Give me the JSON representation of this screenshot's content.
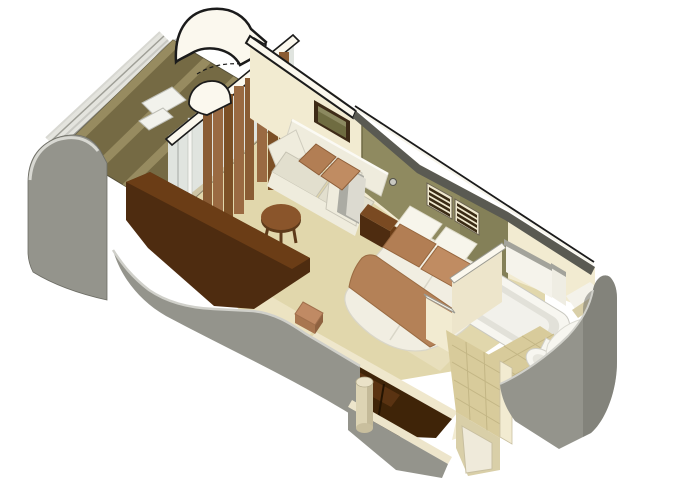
{
  "scene": {
    "title": "Stateroom 3D cutaway floor plan",
    "view": "isometric cutaway from above",
    "rooms": [
      {
        "name": "balcony",
        "items": [
          "teak-deck",
          "deck-lounger",
          "railing"
        ]
      },
      {
        "name": "living-area",
        "items": [
          "sofa",
          "accent-pillows",
          "coffee-table",
          "framed-picture",
          "curtains",
          "sliding-glass-door",
          "vanity-desk",
          "stool"
        ]
      },
      {
        "name": "sleeping-area",
        "items": [
          "double-bed",
          "white-pillows",
          "accent-pillows",
          "bed-runner",
          "nightstand",
          "headboard-wall",
          "air-vents",
          "reading-light-knob"
        ]
      },
      {
        "name": "bathroom",
        "items": [
          "bathtub",
          "toilet",
          "vanity-sink",
          "tiled-floor"
        ]
      },
      {
        "name": "entry",
        "items": [
          "wardrobe-closet",
          "column",
          "tiled-corridor",
          "cabin-door"
        ]
      }
    ]
  },
  "colors": {
    "outline": "#1b1b1b",
    "wallCream": "#F2EBD1",
    "wallBand": "#FBF8EE",
    "bandDark": "#5A5A52",
    "partition": "#EDE5CB",
    "carpet": "#E1D7AC",
    "carpetLight": "#EDE5C6",
    "threshold": "#CFC6A6",
    "grayWall": "#94948C",
    "grayWallDark": "#75756D",
    "grayWallLight": "#D0D0CA",
    "plankDark": "#756A44",
    "plankLight": "#978B60",
    "railBand": "#E4E4DE",
    "glass": "#E0E4DF",
    "mullion": "#F6F6F2",
    "curtainA": "#9A6A42",
    "curtainB": "#7C5026",
    "curtainC": "#8A5C34",
    "sofaBody": "#EFECDD",
    "sofaCushion": "#E2DFCE",
    "sofaArmGray": "#ABABA3",
    "pillowBrown": "#B27E54",
    "pillowBrownLight": "#C08C62",
    "frame": "#3E2B17",
    "art": "#6F6C41",
    "tableWood": "#8A552B",
    "tableWoodDark": "#5E3A1A",
    "olive": "#8F8A60",
    "oliveDark": "#7A7550",
    "ventFrame": "#EFE8CE",
    "ventSlat": "#3A2B15",
    "woodDark": "#4E2C10",
    "woodMid": "#6B3D16",
    "closetDark": "#3F2408",
    "closetShelf": "#5A3312",
    "bedWhite": "#F1EEE2",
    "bedShadow": "#D9D6C8",
    "pillowWhite": "#F7F5EB",
    "runner": "#B48157",
    "tile": "#D8CB9B",
    "tileLine": "#C3B685",
    "porcelain": "#F7F6F0",
    "tubBasin": "#E2E1D9",
    "beigeWall": "#D9CFA8",
    "column": "#DDD4B4",
    "columnLight": "#EAE2C8",
    "stool": "#C08A64",
    "stoolDark": "#A87650",
    "knob": "#C9C9C1",
    "whiteFurniture": "#F2F2EC"
  }
}
